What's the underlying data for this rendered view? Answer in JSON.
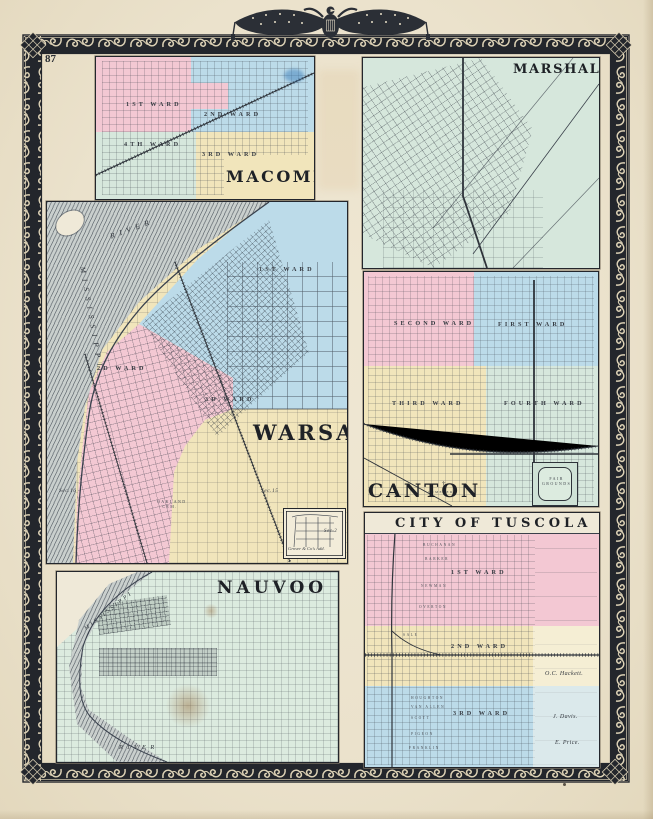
{
  "page": {
    "number": "87"
  },
  "ornaments": {
    "emblem": "eagle with draped star flags",
    "border": "scroll vine border",
    "corner": "pineapple finial"
  },
  "colors": {
    "paper": "#ebe2cc",
    "ink": "#23262c",
    "pink": "#f3c8d3",
    "blue": "#bcdbe9",
    "yellow": "#f1e5bb",
    "green": "#d6e7dc",
    "palegreen": "#dcebdf",
    "river": "#c9cfcd"
  },
  "macomb": {
    "title": "MACOMB",
    "ward1": "1ST WARD",
    "ward2": "2ND WARD",
    "ward3": "3RD WARD",
    "ward4": "4TH WARD"
  },
  "marshall": {
    "title": "MARSHALL"
  },
  "warsaw": {
    "title": "WARSAW",
    "ward1": "1ST WARD",
    "ward2": "2D WARD",
    "ward3": "3D WARD",
    "mississippi": "MISSISSIPPI",
    "river": "RIVER",
    "sec16": "Sec.16",
    "sec15": "Sec.15",
    "sec2": "Sec.2",
    "cem": "OAKLAND CEM.",
    "inset": "Grover & Co's Add."
  },
  "canton": {
    "title": "CANTON",
    "ward1": "FIRST WARD",
    "ward2": "SECOND WARD",
    "ward3": "THIRD WARD",
    "ward4": "FOURTH WARD",
    "fair1": "FAIR",
    "fair2": "GROUNDS",
    "cemetery": "CEMETERY"
  },
  "nauvoo": {
    "title": "NAUVOO",
    "mississippi": "MISSISSIPPI",
    "river": "RIVER"
  },
  "tuscola": {
    "title": "CITY OF TUSCOLA",
    "ward1": "1ST WARD",
    "ward2": "2ND WARD",
    "ward3": "3RD WARD",
    "owner1": "O.C. Hackett.",
    "owner2": "J. Davis.",
    "owner3": "E. Price.",
    "streets": [
      "BUCHANAN",
      "BARKER",
      "NEWMAN",
      "OVERTON",
      "SALE",
      "HOUGHTON",
      "VAN ALLEN",
      "SCOTT",
      "PIGEON",
      "FRANKLIN"
    ]
  }
}
